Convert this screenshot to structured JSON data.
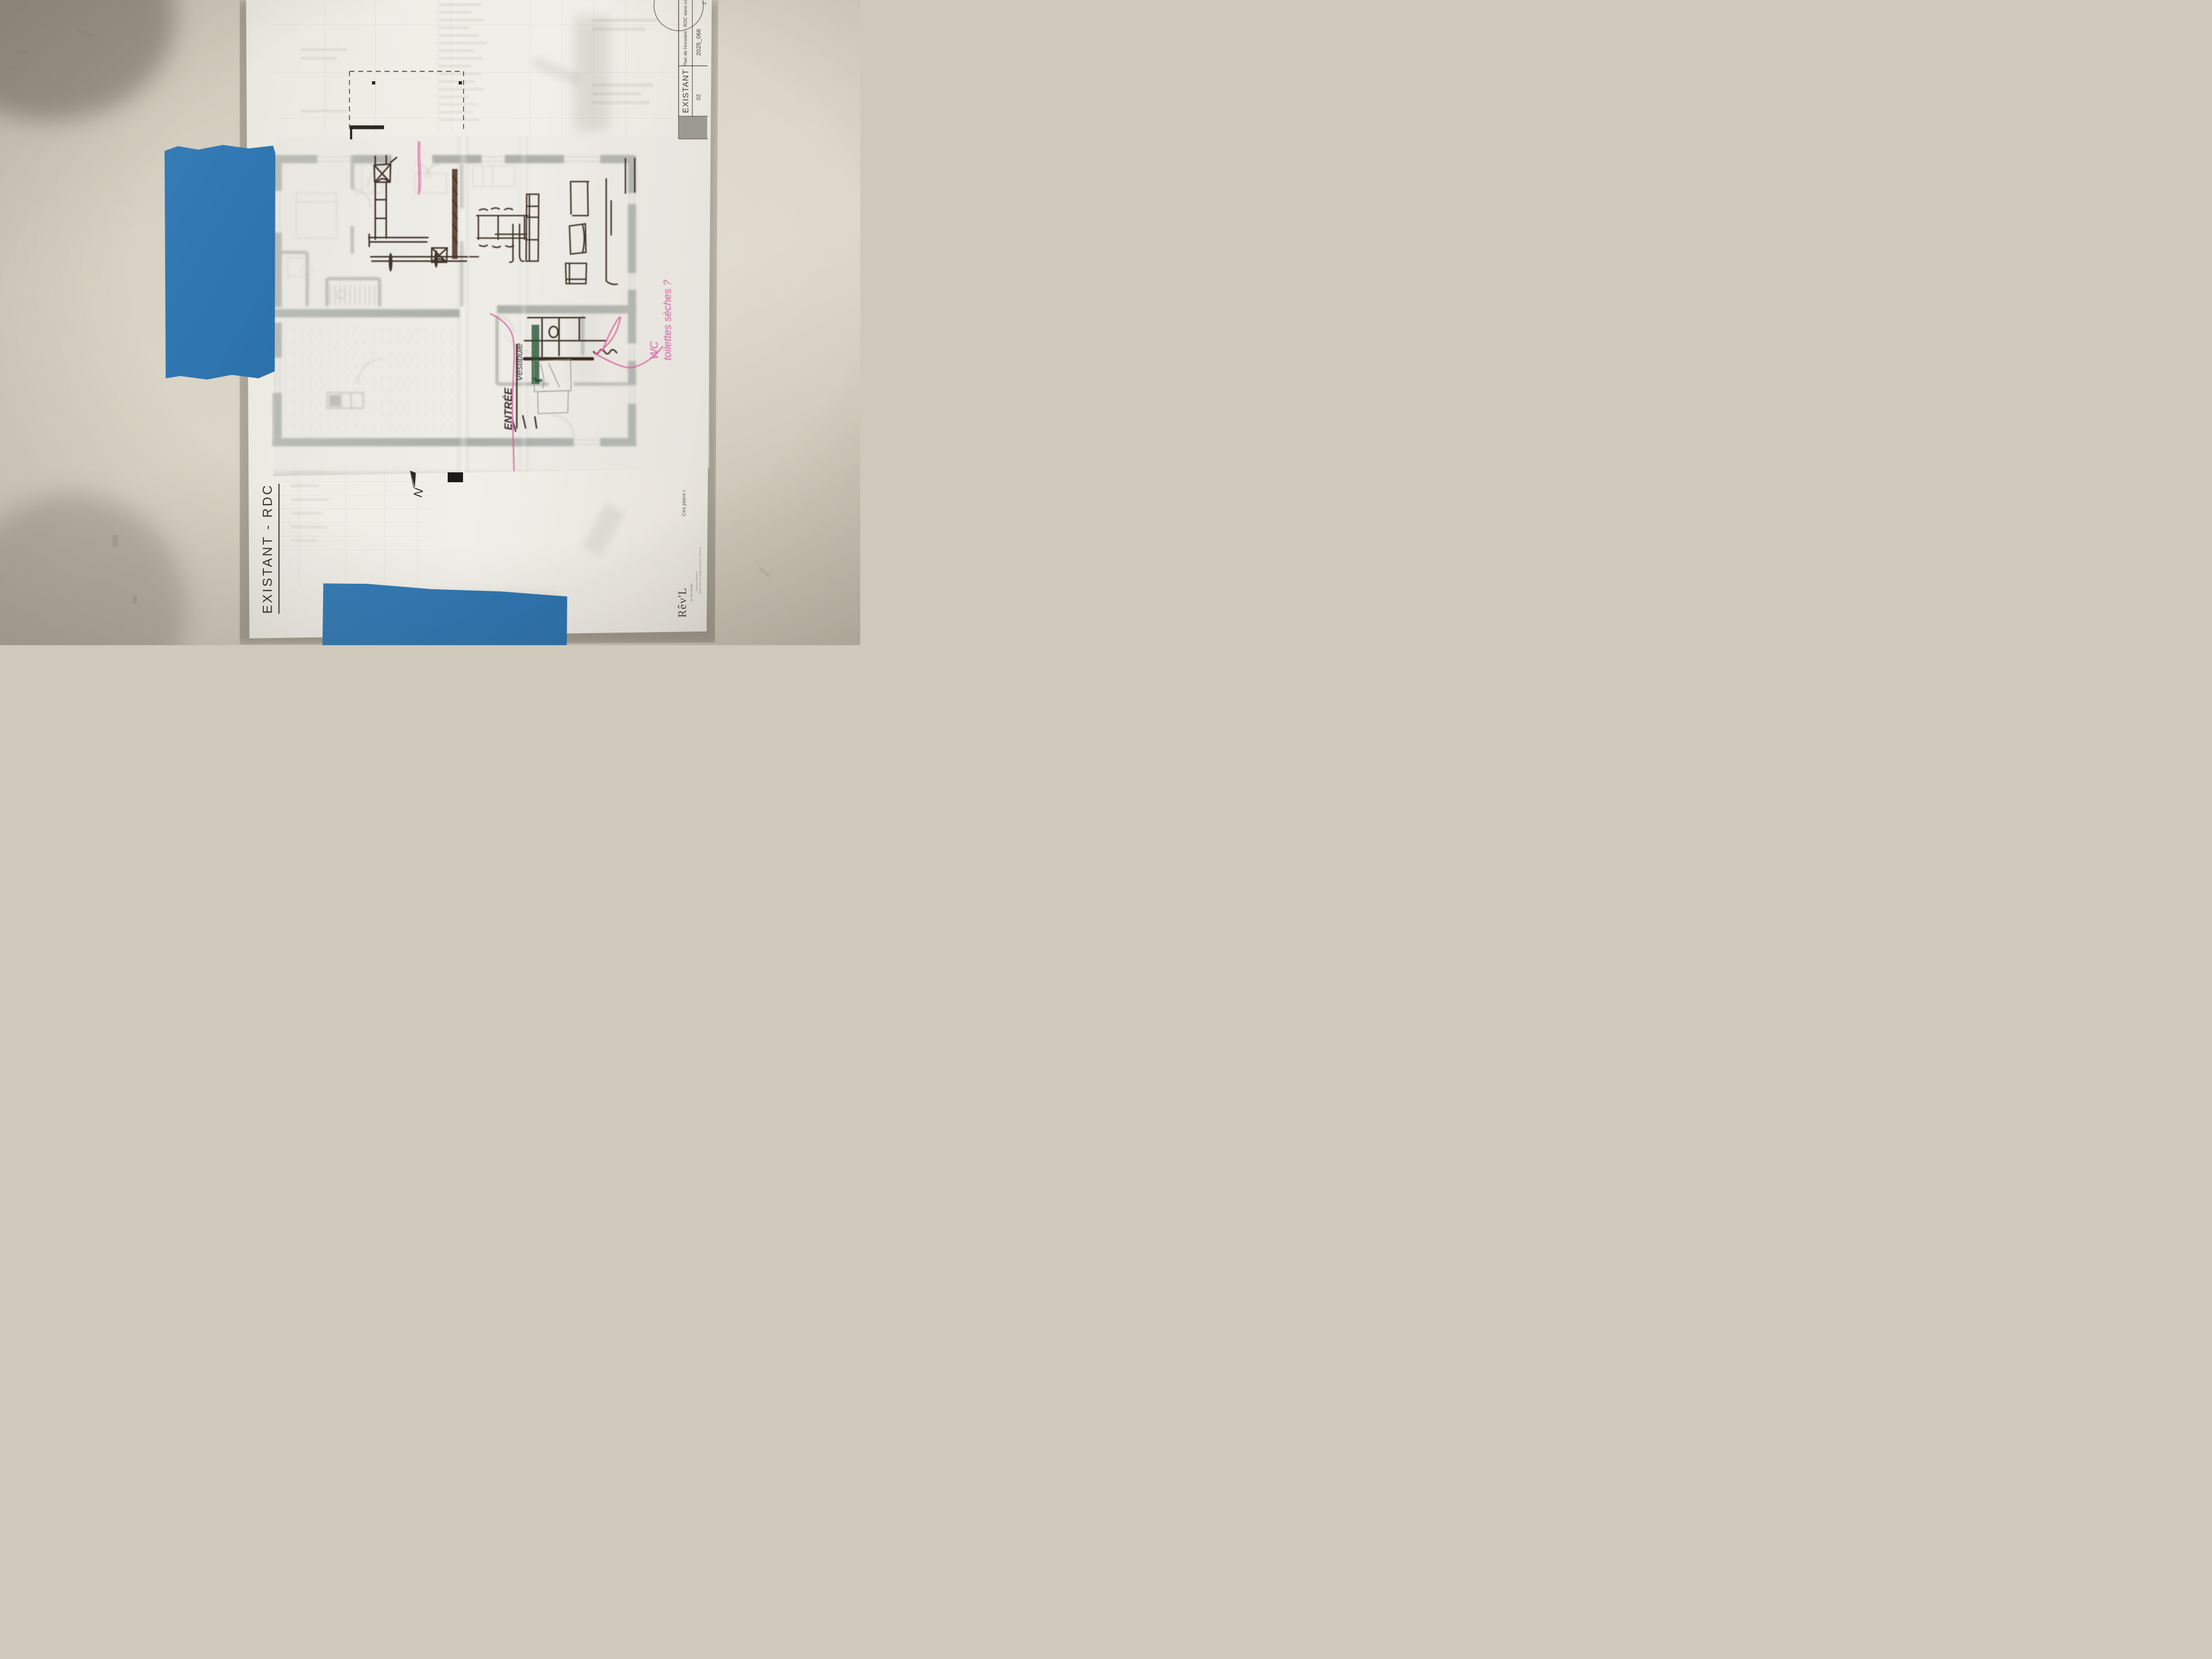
{
  "labels": {
    "side_title": "EXISTANT - RDC",
    "north": "N",
    "footer_note": "Ces plans r"
  },
  "title_block": {
    "row1_label": "Plan de l'existant - RDC sans co",
    "row1_value": "2025_066",
    "row2_label": "EXISTANT",
    "row2_value": "02",
    "corner_digit": "2"
  },
  "logo": {
    "name": "Rêv'L",
    "tagline": "by rêve design",
    "small_line1": "laurence dumond",
    "small_line2": "agencement et design d'espaces intérieurs"
  },
  "annotations": {
    "wc_line1": "WC",
    "wc_line2": "toilettes sèches ?",
    "entree": "ENTRÉE",
    "vestibule": "Vestibule"
  },
  "colors": {
    "tape_blue": "#3077b2",
    "marker_pink": "#d95f9f",
    "marker_green": "#1f5233",
    "ink_dark": "#42352b",
    "print_grey": "#6a716c",
    "wall_beige": "#d6d0c2"
  }
}
